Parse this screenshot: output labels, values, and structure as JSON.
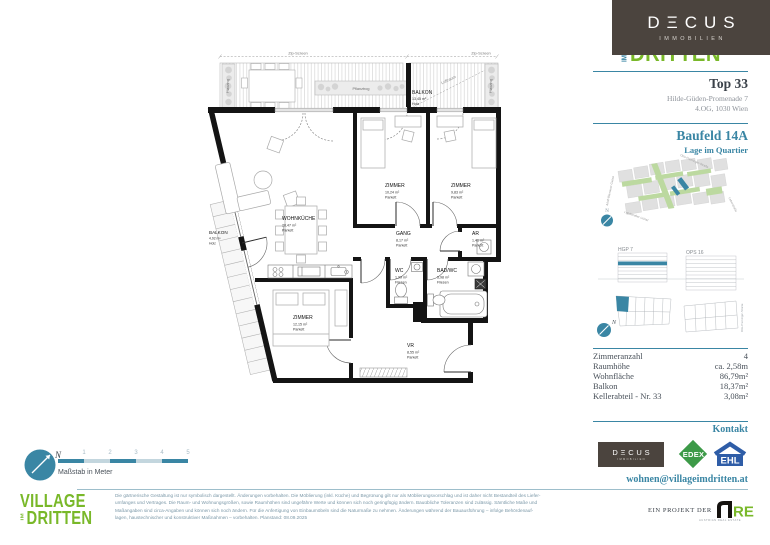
{
  "brand": {
    "decus_display": "DΞCUS",
    "decus_sub": "IMMOBILIEN",
    "village_im": "IM",
    "village_dritten": "DRITTEN"
  },
  "compass_letter": "N",
  "header": {
    "unit": "Top 33",
    "address_line1": "Hilde-Güden-Promenade 7",
    "address_line2": "4.OG, 1030 Wien",
    "baufeld": "Baufeld 14A",
    "baufeld_sub": "Lage im Quartier"
  },
  "map": {
    "street_top": "Otto-Preminger-Straße",
    "street_left": "Adolf-Blamauer-Gasse",
    "street_bottom": "Landstraßer Gürtel",
    "street_right": "Leberstraße"
  },
  "site": {
    "left_label": "HGP 7",
    "right_label": "OPS 16",
    "street_vertical": "Otto-Preminger-Straße"
  },
  "facts": {
    "rows": [
      {
        "label": "Zimmeranzahl",
        "value": "4"
      },
      {
        "label": "Raumhöhe",
        "value": "ca. 2,58m"
      },
      {
        "label": "Wohnfläche",
        "value": "86,79m²"
      },
      {
        "label": "Balkon",
        "value": "18,37m²"
      },
      {
        "label": "Kellerabteil - Nr. 33",
        "value": "3,08m²"
      }
    ]
  },
  "kontakt": {
    "title": "Kontakt",
    "email": "wohnen@villageimdritten.at",
    "edex": "EDEX",
    "ehl": "EHL",
    "project_label": "EIN PROJEKT DER",
    "are_text": "RE",
    "are_sub": "AUSTRIAN REAL ESTATE"
  },
  "footer": {
    "scale_label": "Maßstab in Meter",
    "scale_ticks": [
      "1",
      "2",
      "3",
      "4",
      "5"
    ],
    "village_line1": "VILLAGE",
    "disclaimer": [
      "Die gärtnerische Gestaltung ist nur symbolisch dargestellt. Änderungen vorbehalten. Die Möblierung (inkl. Küche) und Begrünung gilt nur als Möblierungsvorschlag und ist daher nicht Bestandteil des Liefer-",
      "umfanges und Vertrages. Die Raum- und Wohnungsgrößen, sowie Raumhöhen sind ungefähre Werte und können sich noch geringfügig ändern. Bauübliche Toleranzen sind zulässig. Sämtliche Maße und",
      "Maßangaben sind circa-Angaben und können sich noch ändern. Für die Anfertigung von Einbaumöbeln sind die Naturmaße zu nehmen. Änderungen während der Bauausführung – infolge Behördenauf-",
      "lagen, haustechnischer und konstruktiver Maßnahmen – vorbehalten. Planstand: 08.09.2025"
    ]
  },
  "plan": {
    "zip_screen": "Zip-Screen",
    "luftraum": "Luftraum",
    "pflanztrog": "Pflanztrog",
    "balkon_top": {
      "name": "BALKON",
      "area": "13,45 m²",
      "floor": "Holz"
    },
    "balkon_left": {
      "name": "BALKON",
      "area": "4,92 m²",
      "floor": "Holz"
    },
    "rooms": [
      {
        "name": "WOHNKÜCHE",
        "area": "28,47 m²",
        "floor": "Parkett"
      },
      {
        "name": "ZIMMER",
        "area": "10,24 m²",
        "floor": "Parkett"
      },
      {
        "name": "ZIMMER",
        "area": "9,83 m²",
        "floor": "Parkett"
      },
      {
        "name": "GANG",
        "area": "8,17 m²",
        "floor": "Parkett"
      },
      {
        "name": "AR",
        "area": "1,41 m²",
        "floor": "Parkett"
      },
      {
        "name": "WC",
        "area": "1,99 m²",
        "floor": "Fliesen"
      },
      {
        "name": "BAD/WC",
        "area": "5,98 m²",
        "floor": "Fliesen"
      },
      {
        "name": "ZIMMER",
        "area": "12,15 m²",
        "floor": "Parkett"
      },
      {
        "name": "VR",
        "area": "8,55 m²",
        "floor": "Parkett"
      }
    ]
  }
}
